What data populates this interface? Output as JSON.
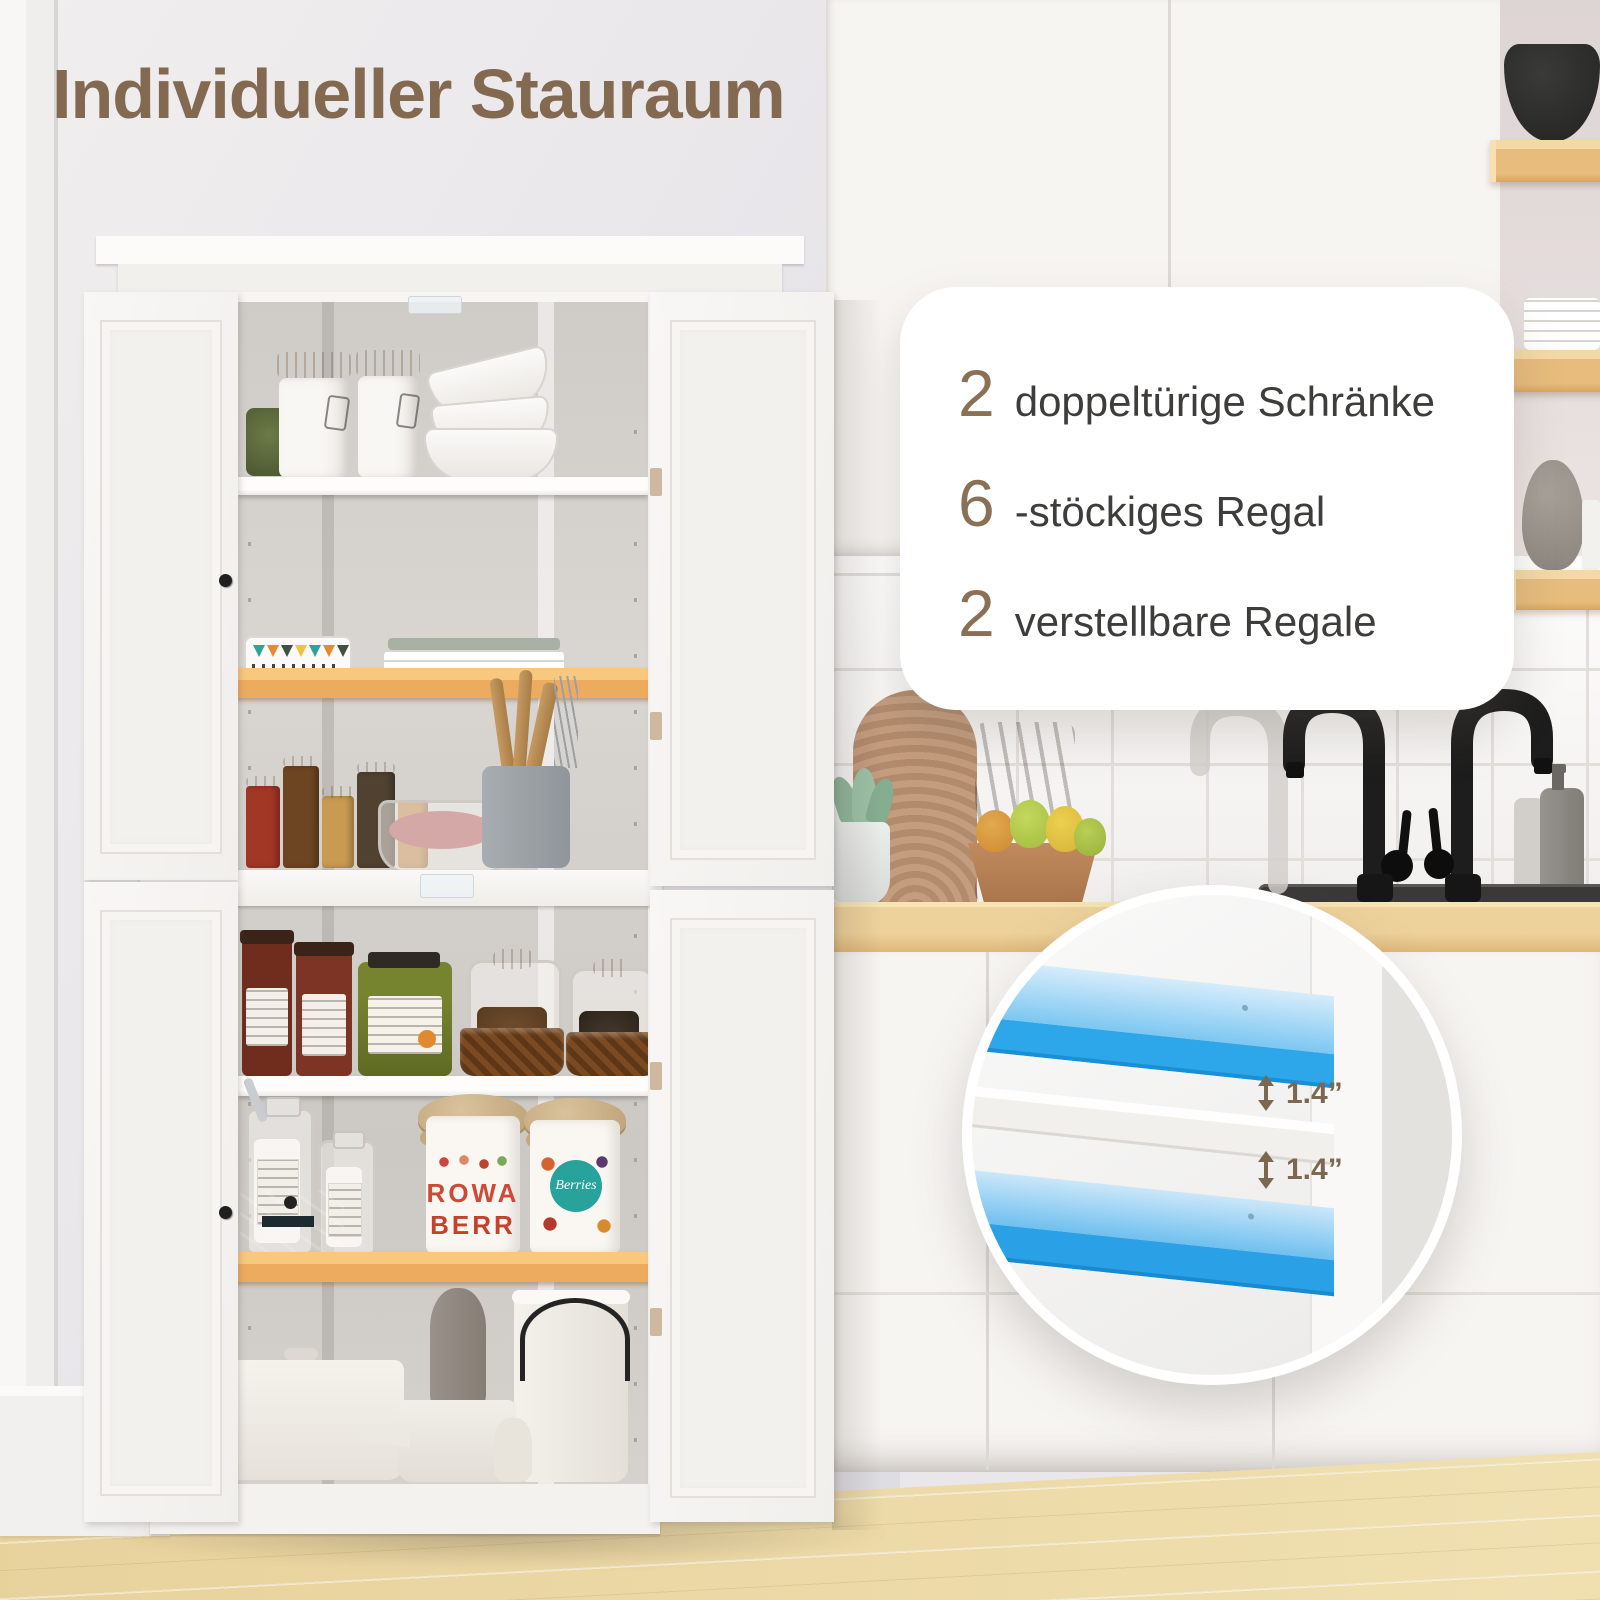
{
  "title": "Individueller Stauraum",
  "card": {
    "features": [
      {
        "number": "2",
        "label": "doppeltürige Schränke"
      },
      {
        "number": "6",
        "label": "-stöckiges Regal"
      },
      {
        "number": "2",
        "label": "verstellbare Regale"
      }
    ]
  },
  "inset": {
    "measurements": [
      {
        "value": "1.4”"
      },
      {
        "value": "1.4”"
      }
    ]
  },
  "decor": {
    "berry_jar_front": {
      "line1": "ROWA",
      "line2": "BERR"
    },
    "berry_jar_back": "Berries"
  },
  "colors": {
    "accent_blue": "#2ea6ea",
    "shelf_orange": "#f2b96e",
    "title_brown": "#82694f",
    "number_brown": "#8a7055",
    "text_dark": "#3e3d3c",
    "measure_brown": "#7c6850"
  }
}
